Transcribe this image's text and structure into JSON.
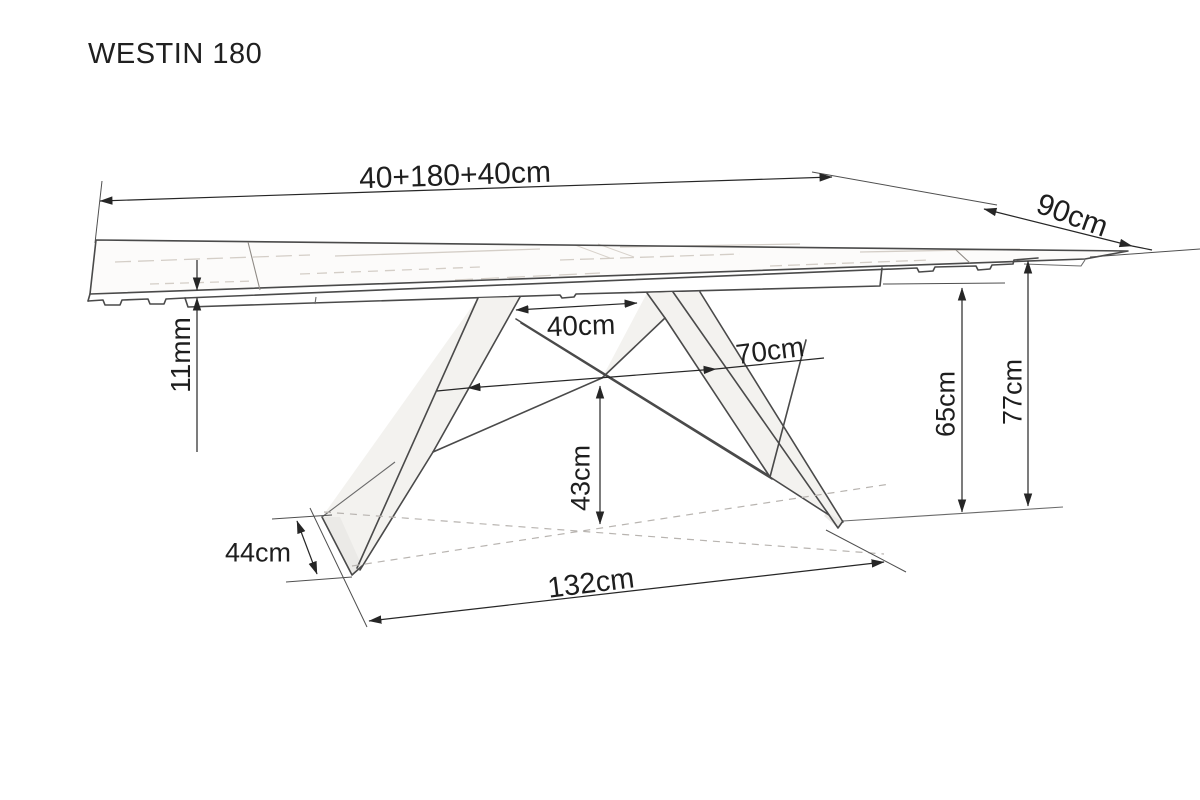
{
  "title": "WESTIN 180",
  "dimensions": {
    "total_length": "40+180+40cm",
    "depth": "90cm",
    "top_thickness": "11mm",
    "top_attach_gap": "40cm",
    "mid_span": "70cm",
    "under_clearance": "43cm",
    "underside_height": "65cm",
    "total_height": "77cm",
    "foot_width": "44cm",
    "base_length": "132cm"
  },
  "colors": {
    "background": "#ffffff",
    "line": "#4a4a4a",
    "dimension_line": "#262626",
    "dashed_line": "#b8b4b0",
    "label_text": "#1e1e1e"
  }
}
